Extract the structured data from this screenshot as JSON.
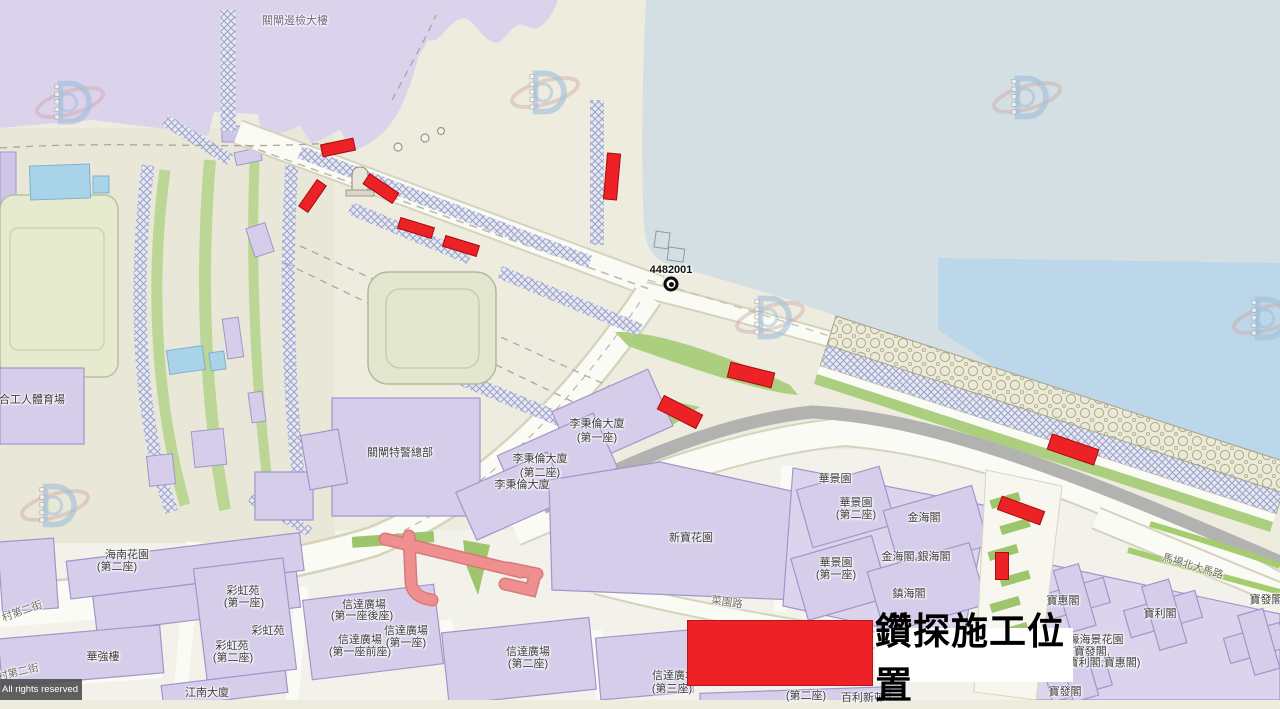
{
  "map": {
    "area": "Portas do Cerco / border gate district cadastral map",
    "colors": {
      "drill_red": "#ec2227",
      "water": "#d3dfe2",
      "open_sea": "#bcd7e9",
      "building": "#d6cdea",
      "plaza": "#dbd2ec",
      "green": "#abcf7e"
    },
    "legend": {
      "label": "鑽探施工位置",
      "swatch_color": "#ec2227",
      "swatch": {
        "x": 687,
        "y": 620,
        "w": 186,
        "h": 66
      }
    },
    "copyright": "All rights reserved",
    "marker": {
      "id": "4482001",
      "x": 671,
      "y": 284
    },
    "labels": [
      {
        "t": "關閘邊檢大樓",
        "x": 295,
        "y": 20,
        "cls": "plaza"
      },
      {
        "t": "4482001",
        "x": 671,
        "y": 270,
        "b": true
      },
      {
        "t": "合工人體育場",
        "x": 32,
        "y": 399
      },
      {
        "t": "關閘特警總部",
        "x": 400,
        "y": 452
      },
      {
        "t": "李秉倫大廈",
        "x": 597,
        "y": 423
      },
      {
        "t": "(第一座)",
        "x": 597,
        "y": 437
      },
      {
        "t": "李秉倫大廈",
        "x": 540,
        "y": 458
      },
      {
        "t": "(第二座)",
        "x": 540,
        "y": 472
      },
      {
        "t": "李秉倫大廈",
        "x": 522,
        "y": 484
      },
      {
        "t": "海南花園",
        "x": 127,
        "y": 554
      },
      {
        "t": "(第二座)",
        "x": 117,
        "y": 566
      },
      {
        "t": "彩虹苑",
        "x": 243,
        "y": 590
      },
      {
        "t": "(第一座)",
        "x": 244,
        "y": 602
      },
      {
        "t": "彩虹苑",
        "x": 268,
        "y": 630
      },
      {
        "t": "彩虹苑",
        "x": 232,
        "y": 645
      },
      {
        "t": "(第二座)",
        "x": 233,
        "y": 657
      },
      {
        "t": "華強樓",
        "x": 103,
        "y": 656
      },
      {
        "t": "江南大廈",
        "x": 207,
        "y": 692
      },
      {
        "t": "信達廣場",
        "x": 364,
        "y": 604
      },
      {
        "t": "(第一座後座)",
        "x": 362,
        "y": 615
      },
      {
        "t": "信達廣場",
        "x": 360,
        "y": 639
      },
      {
        "t": "(第一座前座)",
        "x": 360,
        "y": 651
      },
      {
        "t": "信達廣場",
        "x": 406,
        "y": 630
      },
      {
        "t": "(第一座)",
        "x": 406,
        "y": 642
      },
      {
        "t": "信達廣場",
        "x": 528,
        "y": 651
      },
      {
        "t": "(第二座)",
        "x": 528,
        "y": 663
      },
      {
        "t": "信達廣場",
        "x": 674,
        "y": 675
      },
      {
        "t": "(第三座)",
        "x": 672,
        "y": 688
      },
      {
        "t": "(第二座)",
        "x": 806,
        "y": 695
      },
      {
        "t": "百利新邨",
        "x": 863,
        "y": 697
      },
      {
        "t": "新寶花園",
        "x": 691,
        "y": 537
      },
      {
        "t": "華景園",
        "x": 835,
        "y": 478
      },
      {
        "t": "華景園",
        "x": 856,
        "y": 502
      },
      {
        "t": "(第二座)",
        "x": 856,
        "y": 514
      },
      {
        "t": "金海閣",
        "x": 924,
        "y": 517
      },
      {
        "t": "金海閣,銀海閣",
        "x": 916,
        "y": 556
      },
      {
        "t": "華景園",
        "x": 836,
        "y": 562
      },
      {
        "t": "(第一座)",
        "x": 836,
        "y": 574
      },
      {
        "t": "鎮海閣",
        "x": 909,
        "y": 593
      },
      {
        "t": "寶惠閣",
        "x": 1063,
        "y": 600
      },
      {
        "t": "寶利閣",
        "x": 1160,
        "y": 613
      },
      {
        "t": "濠海景花園",
        "x": 1096,
        "y": 639
      },
      {
        "t": "(寶發閣,",
        "x": 1090,
        "y": 651
      },
      {
        "t": "寶利閣,寶惠閣)",
        "x": 1104,
        "y": 662
      },
      {
        "t": "寶發閣",
        "x": 1065,
        "y": 691
      },
      {
        "t": "寶發閣",
        "x": 1266,
        "y": 599
      },
      {
        "t": "菜園路",
        "x": 727,
        "y": 602,
        "r": 9,
        "cls": "street"
      },
      {
        "t": "馬場北大馬路",
        "x": 1193,
        "y": 566,
        "r": 17,
        "cls": "street"
      },
      {
        "t": "村第二街",
        "x": 22,
        "y": 611,
        "r": -20,
        "cls": "street"
      },
      {
        "t": "村第二街",
        "x": 18,
        "y": 672,
        "r": -13,
        "cls": "street"
      }
    ],
    "drill_boxes": [
      {
        "cx": 338,
        "cy": 147,
        "w": 34,
        "h": 13,
        "r": -12
      },
      {
        "cx": 312,
        "cy": 196,
        "w": 33,
        "h": 12,
        "r": -55
      },
      {
        "cx": 381,
        "cy": 188,
        "w": 36,
        "h": 13,
        "r": 34
      },
      {
        "cx": 416,
        "cy": 228,
        "w": 36,
        "h": 12,
        "r": 17
      },
      {
        "cx": 461,
        "cy": 246,
        "w": 36,
        "h": 12,
        "r": 17
      },
      {
        "cx": 612,
        "cy": 176,
        "w": 14,
        "h": 47,
        "r": 5
      },
      {
        "cx": 751,
        "cy": 375,
        "w": 46,
        "h": 16,
        "r": 14
      },
      {
        "cx": 680,
        "cy": 412,
        "w": 44,
        "h": 16,
        "r": 27
      },
      {
        "cx": 1073,
        "cy": 449,
        "w": 50,
        "h": 17,
        "r": 19
      },
      {
        "cx": 1021,
        "cy": 510,
        "w": 46,
        "h": 15,
        "r": 20
      },
      {
        "cx": 1002,
        "cy": 566,
        "w": 14,
        "h": 28,
        "r": 0
      }
    ]
  }
}
